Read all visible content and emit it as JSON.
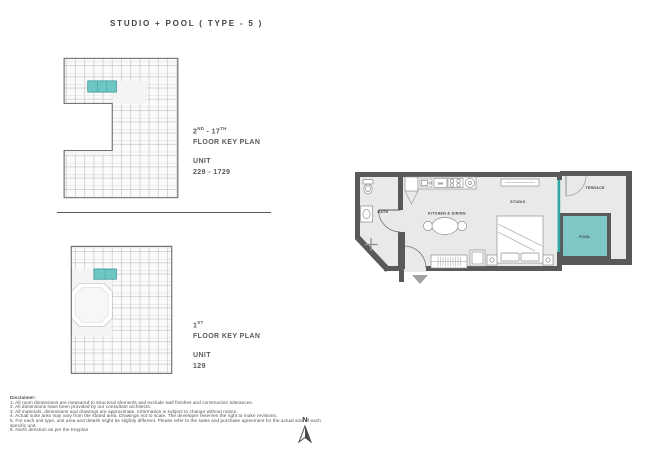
{
  "page": {
    "title": "STUDIO + POOL ( TYPE - 5 )"
  },
  "key_plans": {
    "upper": {
      "floor_num_1": "2",
      "floor_sup_1": "ND",
      "floor_sep": " - ",
      "floor_num_2": "17",
      "floor_sup_2": "TH",
      "floor_plan_label": "FLOOR KEY PLAN",
      "unit_label": "UNIT",
      "unit_range": "229 - 1729"
    },
    "lower": {
      "floor_num_1": "1",
      "floor_sup_1": "ST",
      "floor_plan_label": "FLOOR KEY PLAN",
      "unit_label": "UNIT",
      "unit_range": "129"
    }
  },
  "floor_plan": {
    "labels": {
      "bath": "BATH",
      "kitchen_dining": "KITCHEN & DINING",
      "studio": "STUDIO",
      "terrace": "TERRACE",
      "pool": "POOL",
      "dishwasher": "DW"
    }
  },
  "compass": {
    "label": "N"
  },
  "disclaimer": {
    "heading": "Disclaimer:",
    "lines": [
      "1. All room dimensions are measured to structural elements and exclude wall finishes and construction tolerances.",
      "2. All dimensions have been provided by our consultant architects.",
      "3. All materials, dimensions and drawings are approximate. Information is subject to change without notice.",
      "4. Actual suite area may vary from the stated area. Drawings not to scale. The developer reserves the right to make revisions.",
      "5. For each unit type, unit area and details might be slightly different. Please refer to the sales and purchase agreement for the actual size of each specific unit.",
      "6. North direction as per the Keyplan"
    ]
  },
  "colors": {
    "wall_gray": "#58595b",
    "floor_gray": "#e8e9e9",
    "pool_teal": "#7fc7c4",
    "accent_teal": "#2fa8a5",
    "keyplan_highlight": "#6fc7c4"
  }
}
